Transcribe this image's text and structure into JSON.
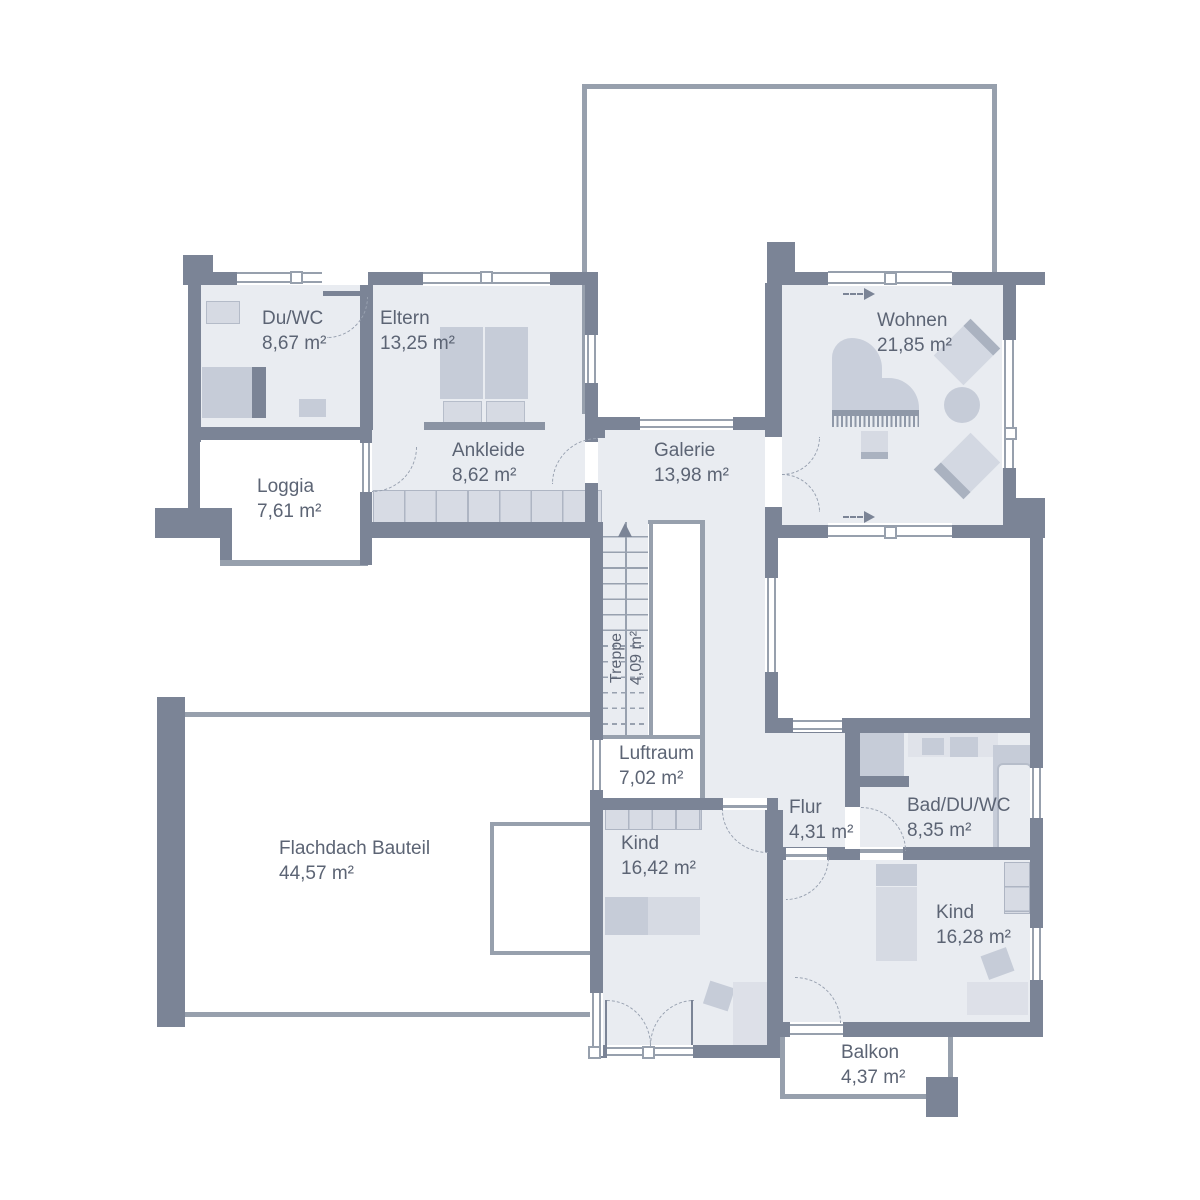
{
  "colors": {
    "wall": "#7b8496",
    "room_fill": "#e9ecf1",
    "thin_outline": "#97a0ad",
    "furniture_light": "#d6dae3",
    "furniture_mid": "#c6ccd8",
    "furniture_dark": "#aab2c0",
    "label_text": "#5c6474",
    "background": "#ffffff"
  },
  "icons": {
    "stairs_up_arrow": "triangle pointing up",
    "sliding_door_arrow": "dashed line with right arrow"
  },
  "rooms": [
    {
      "name": "Du/WC",
      "area": "8,67 m²"
    },
    {
      "name": "Eltern",
      "area": "13,25 m²"
    },
    {
      "name": "Loggia",
      "area": "7,61 m²"
    },
    {
      "name": "Ankleide",
      "area": "8,62 m²"
    },
    {
      "name": "Galerie",
      "area": "13,98 m²"
    },
    {
      "name": "Wohnen",
      "area": "21,85 m²"
    },
    {
      "name": "Treppe",
      "area": "4,09 m²"
    },
    {
      "name": "Luftraum",
      "area": "7,02 m²"
    },
    {
      "name": "Flachdach Bauteil",
      "area": "44,57 m²"
    },
    {
      "name": "Kind",
      "area": "16,42 m²"
    },
    {
      "name": "Flur",
      "area": "4,31 m²"
    },
    {
      "name": "Bad/DU/WC",
      "area": "8,35 m²"
    },
    {
      "name": "Kind",
      "area": "16,28 m²"
    },
    {
      "name": "Balkon",
      "area": "4,37 m²"
    }
  ]
}
